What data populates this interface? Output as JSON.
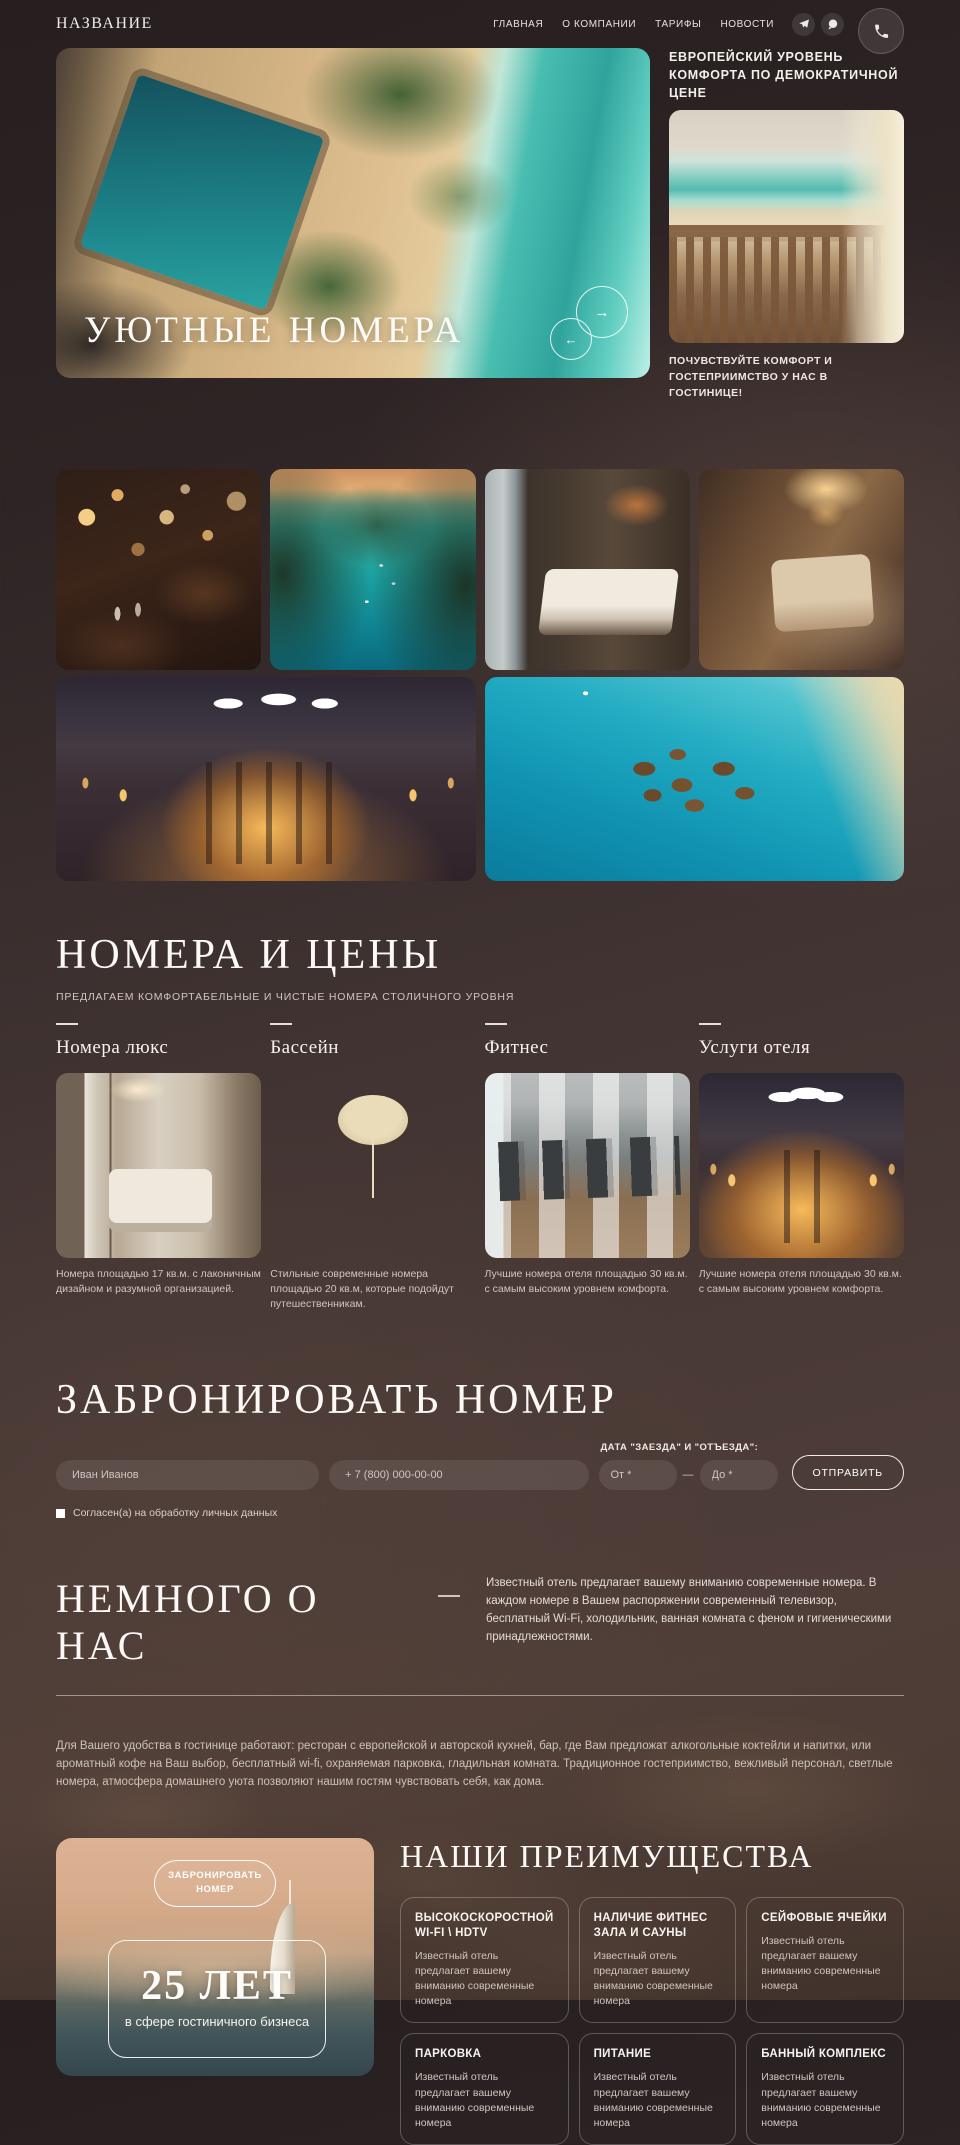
{
  "header": {
    "logo": "НАЗВАНИЕ",
    "nav": [
      "ГЛАВНАЯ",
      "О КОМПАНИИ",
      "ТАРИФЫ",
      "НОВОСТИ"
    ],
    "icons": {
      "telegram": "paper-plane",
      "whatsapp": "phone-bubble",
      "call": "handset"
    }
  },
  "hero": {
    "slide_title": "УЮТНЫЕ НОМЕРА",
    "prev_arrow": "←",
    "next_arrow": "→",
    "right_title": "ЕВРОПЕЙСКИЙ УРОВЕНЬ КОМФОРТА ПО ДЕМОКРАТИЧНОЙ ЦЕНЕ",
    "right_caption": "ПОЧУВСТВУЙТЕ КОМФОРТ И ГОСТЕПРИИМСТВО У НАС В ГОСТИНИЦЕ!"
  },
  "rooms": {
    "title": "НОМЕРА И ЦЕНЫ",
    "subtitle": "ПРЕДЛАГАЕМ КОМФОРТАБЕЛЬНЫЕ И ЧИСТЫЕ НОМЕРА СТОЛИЧНОГО УРОВНЯ",
    "cards": [
      {
        "title": "Номера люкс",
        "desc": "Номера площадью 17 кв.м. с лаконичным дизайном и разумной организацией."
      },
      {
        "title": "Бассейн",
        "desc": "Стильные современные номера площадью 20 кв.м, которые подойдут путешественникам."
      },
      {
        "title": "Фитнес",
        "desc": "Лучшие номера отеля площадью 30 кв.м. с самым высоким уровнем комфорта."
      },
      {
        "title": "Услуги отеля",
        "desc": "Лучшие номера отеля площадью 30 кв.м. с самым высоким уровнем комфорта."
      }
    ]
  },
  "booking": {
    "title": "ЗАБРОНИРОВАТЬ НОМЕР",
    "dates_label": "ДАТА \"ЗАЕЗДА\" И \"ОТЪЕЗДА\":",
    "name_placeholder": "Иван Иванов",
    "phone_placeholder": "+ 7 (800) 000-00-00",
    "from_placeholder": "От *",
    "to_placeholder": "До *",
    "range_separator": "—",
    "submit_label": "ОТПРАВИТЬ",
    "consent": "Согласен(а) на обработку личных данных"
  },
  "about": {
    "title": "НЕМНОГО О НАС",
    "lead": "Известный отель предлагает вашему вниманию современные номера. В каждом номере в Вашем распоряжении современный телевизор, бесплатный Wi-Fi, холодильник, ванная комната с феном и гигиеническими принадлежностями.",
    "body": "Для Вашего удобства в гостинице работают: ресторан с европейской и авторской кухней, бар, где Вам предложат алкогольные коктейли и напитки, или ароматный кофе на Ваш выбор, бесплатный wi-fi, охраняемая парковка, гладильная комната. Традиционное гостеприимство, вежливый персонал, светлые номера, атмосфера домашнего уюта позволяют нашим гостям чувствовать себя, как дома."
  },
  "promo": {
    "button": "ЗАБРОНИРОВАТЬ НОМЕР",
    "years": "25 ЛЕТ",
    "years_caption": "в сфере гостиничного бизнеса"
  },
  "advantages": {
    "title": "НАШИ ПРЕИМУЩЕСТВА",
    "items": [
      {
        "title": "ВЫСОКОСКОРОСТНОЙ WI-FI \\ HDTV",
        "desc": "Известный отель предлагает вашему вниманию современные номера"
      },
      {
        "title": "НАЛИЧИЕ ФИТНЕС ЗАЛА И САУНЫ",
        "desc": "Известный отель предлагает вашему вниманию современные номера"
      },
      {
        "title": "СЕЙФОВЫЕ ЯЧЕЙКИ",
        "desc": "Известный отель предлагает вашему вниманию современные номера"
      },
      {
        "title": "ПАРКОВКА",
        "desc": "Известный отель предлагает вашему вниманию современные номера"
      },
      {
        "title": "ПИТАНИЕ",
        "desc": "Известный отель предлагает вашему вниманию современные номера"
      },
      {
        "title": "БАННЫЙ КОМПЛЕКС",
        "desc": "Известный отель предлагает вашему вниманию современные номера"
      }
    ]
  }
}
